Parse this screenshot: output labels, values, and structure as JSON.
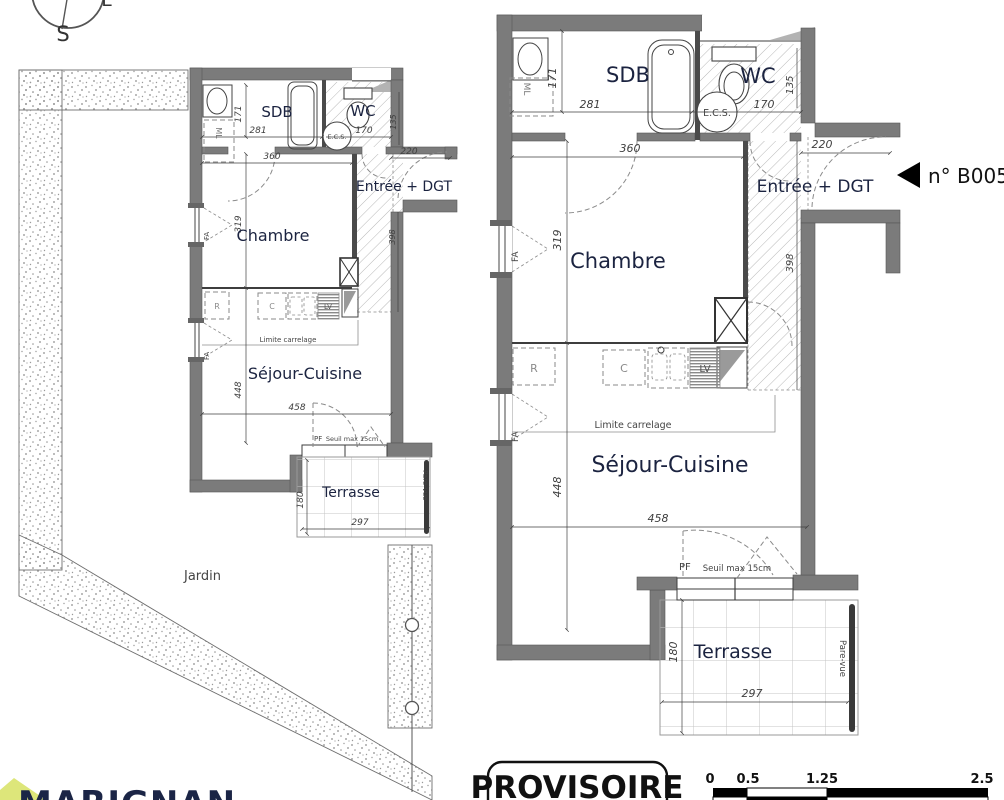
{
  "compass": {
    "south": "S",
    "east": "E"
  },
  "colors": {
    "wall_gray": "#7b7b7b",
    "label_navy": "#1b2340",
    "logo_navy": "#1b2546",
    "logo_green": "#dde67a",
    "stamp_black": "#111111"
  },
  "site_plan": {
    "jardin": "Jardin",
    "rooms": {
      "sdb": "SDB",
      "wc": "WC",
      "chambre": "Chambre",
      "sejour": "Séjour-Cuisine",
      "terrasse": "Terrasse",
      "entree": "Entrée + DGT"
    },
    "fixtures": {
      "ecs": "E.C.S.",
      "ml": "ML",
      "fridge": "R",
      "cooktop": "C",
      "dishwasher": "LV",
      "window_a": "FA",
      "window_b": "FA",
      "door": "PF"
    },
    "notes": {
      "limite": "Limite carrelage",
      "seuil": "Seuil max 15cm",
      "parevue": "Pare-vue"
    },
    "dims": {
      "d171": "171",
      "d281": "281",
      "d170": "170",
      "d135": "135",
      "d360": "360",
      "d220": "220",
      "d319": "319",
      "d398": "398",
      "d448": "448",
      "d458": "458",
      "d180": "180",
      "d297": "297"
    }
  },
  "detail_plan": {
    "rooms": {
      "sdb": "SDB",
      "wc": "WC",
      "chambre": "Chambre",
      "sejour": "Séjour-Cuisine",
      "terrasse": "Terrasse",
      "entree": "Entrée + DGT"
    },
    "fixtures": {
      "ecs": "E.C.S.",
      "ml": "ML",
      "fridge": "R",
      "cooktop": "C",
      "dishwasher": "LV",
      "window_a": "FA",
      "window_b": "FA",
      "door": "PF"
    },
    "notes": {
      "limite": "Limite carrelage",
      "seuil": "Seuil max 15cm",
      "parevue": "Pare-vue"
    },
    "dims": {
      "d171": "171",
      "d281": "281",
      "d170": "170",
      "d135": "135",
      "d360": "360",
      "d220": "220",
      "d319": "319",
      "d398": "398",
      "d448": "448",
      "d458": "458",
      "d180": "180",
      "d297": "297"
    }
  },
  "unit_marker": {
    "number": "n° B005"
  },
  "stamp": {
    "text": "PROVISOIRE"
  },
  "scale_bar": {
    "t0": "0",
    "t1": "0.5",
    "t2": "1.25",
    "t3": "2.5"
  },
  "logo": {
    "text": "MARIGNAN"
  }
}
